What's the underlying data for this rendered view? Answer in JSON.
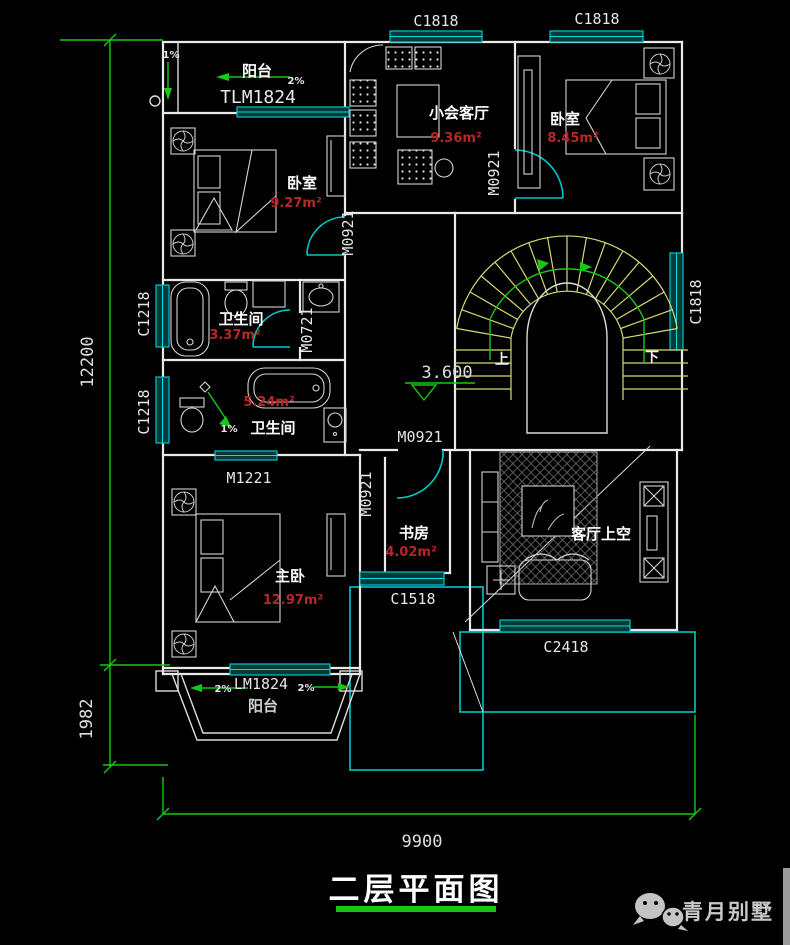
{
  "title": "二层平面图",
  "watermark": "青月别墅",
  "level_marker": "3.600",
  "dims": {
    "height_main": "12200",
    "height_balcony": "1982",
    "width": "9900"
  },
  "stairs": {
    "up": "上",
    "down": "下"
  },
  "rooms": {
    "balcony_top": {
      "name": "阳台",
      "door": "TLM1824",
      "slope": "2%",
      "side_slope": "1%"
    },
    "bedroom_left": {
      "name": "卧室",
      "area": "9.27m²"
    },
    "parlor": {
      "name": "小会客厅",
      "area": "9.36m²"
    },
    "bedroom_right": {
      "name": "卧室",
      "area": "8.45m²"
    },
    "bath_upper": {
      "name": "卫生间",
      "area": "3.37m²"
    },
    "bath_lower": {
      "name": "卫生间",
      "area": "5.24m²",
      "slope": "1%"
    },
    "study": {
      "name": "书房",
      "area": "4.02m²"
    },
    "master": {
      "name": "主卧",
      "area": "12.97m²"
    },
    "living_void": {
      "name": "客厅上空"
    },
    "balcony_bottom": {
      "name": "阳台",
      "door": "LM1824",
      "slope_left": "2%",
      "slope_right": "2%"
    }
  },
  "windows": {
    "top_left": "C1818",
    "top_right": "C1818",
    "stair": "C1818",
    "bath_upper": "C1218",
    "bath_lower": "C1218",
    "study": "C1518",
    "living": "C2418"
  },
  "doors": {
    "bedroom_left": "M0921",
    "bedroom_right": "M0921",
    "hall": "M0921",
    "study": "M0921",
    "bath_upper": "M0721",
    "bath_lower": "M1221"
  }
}
